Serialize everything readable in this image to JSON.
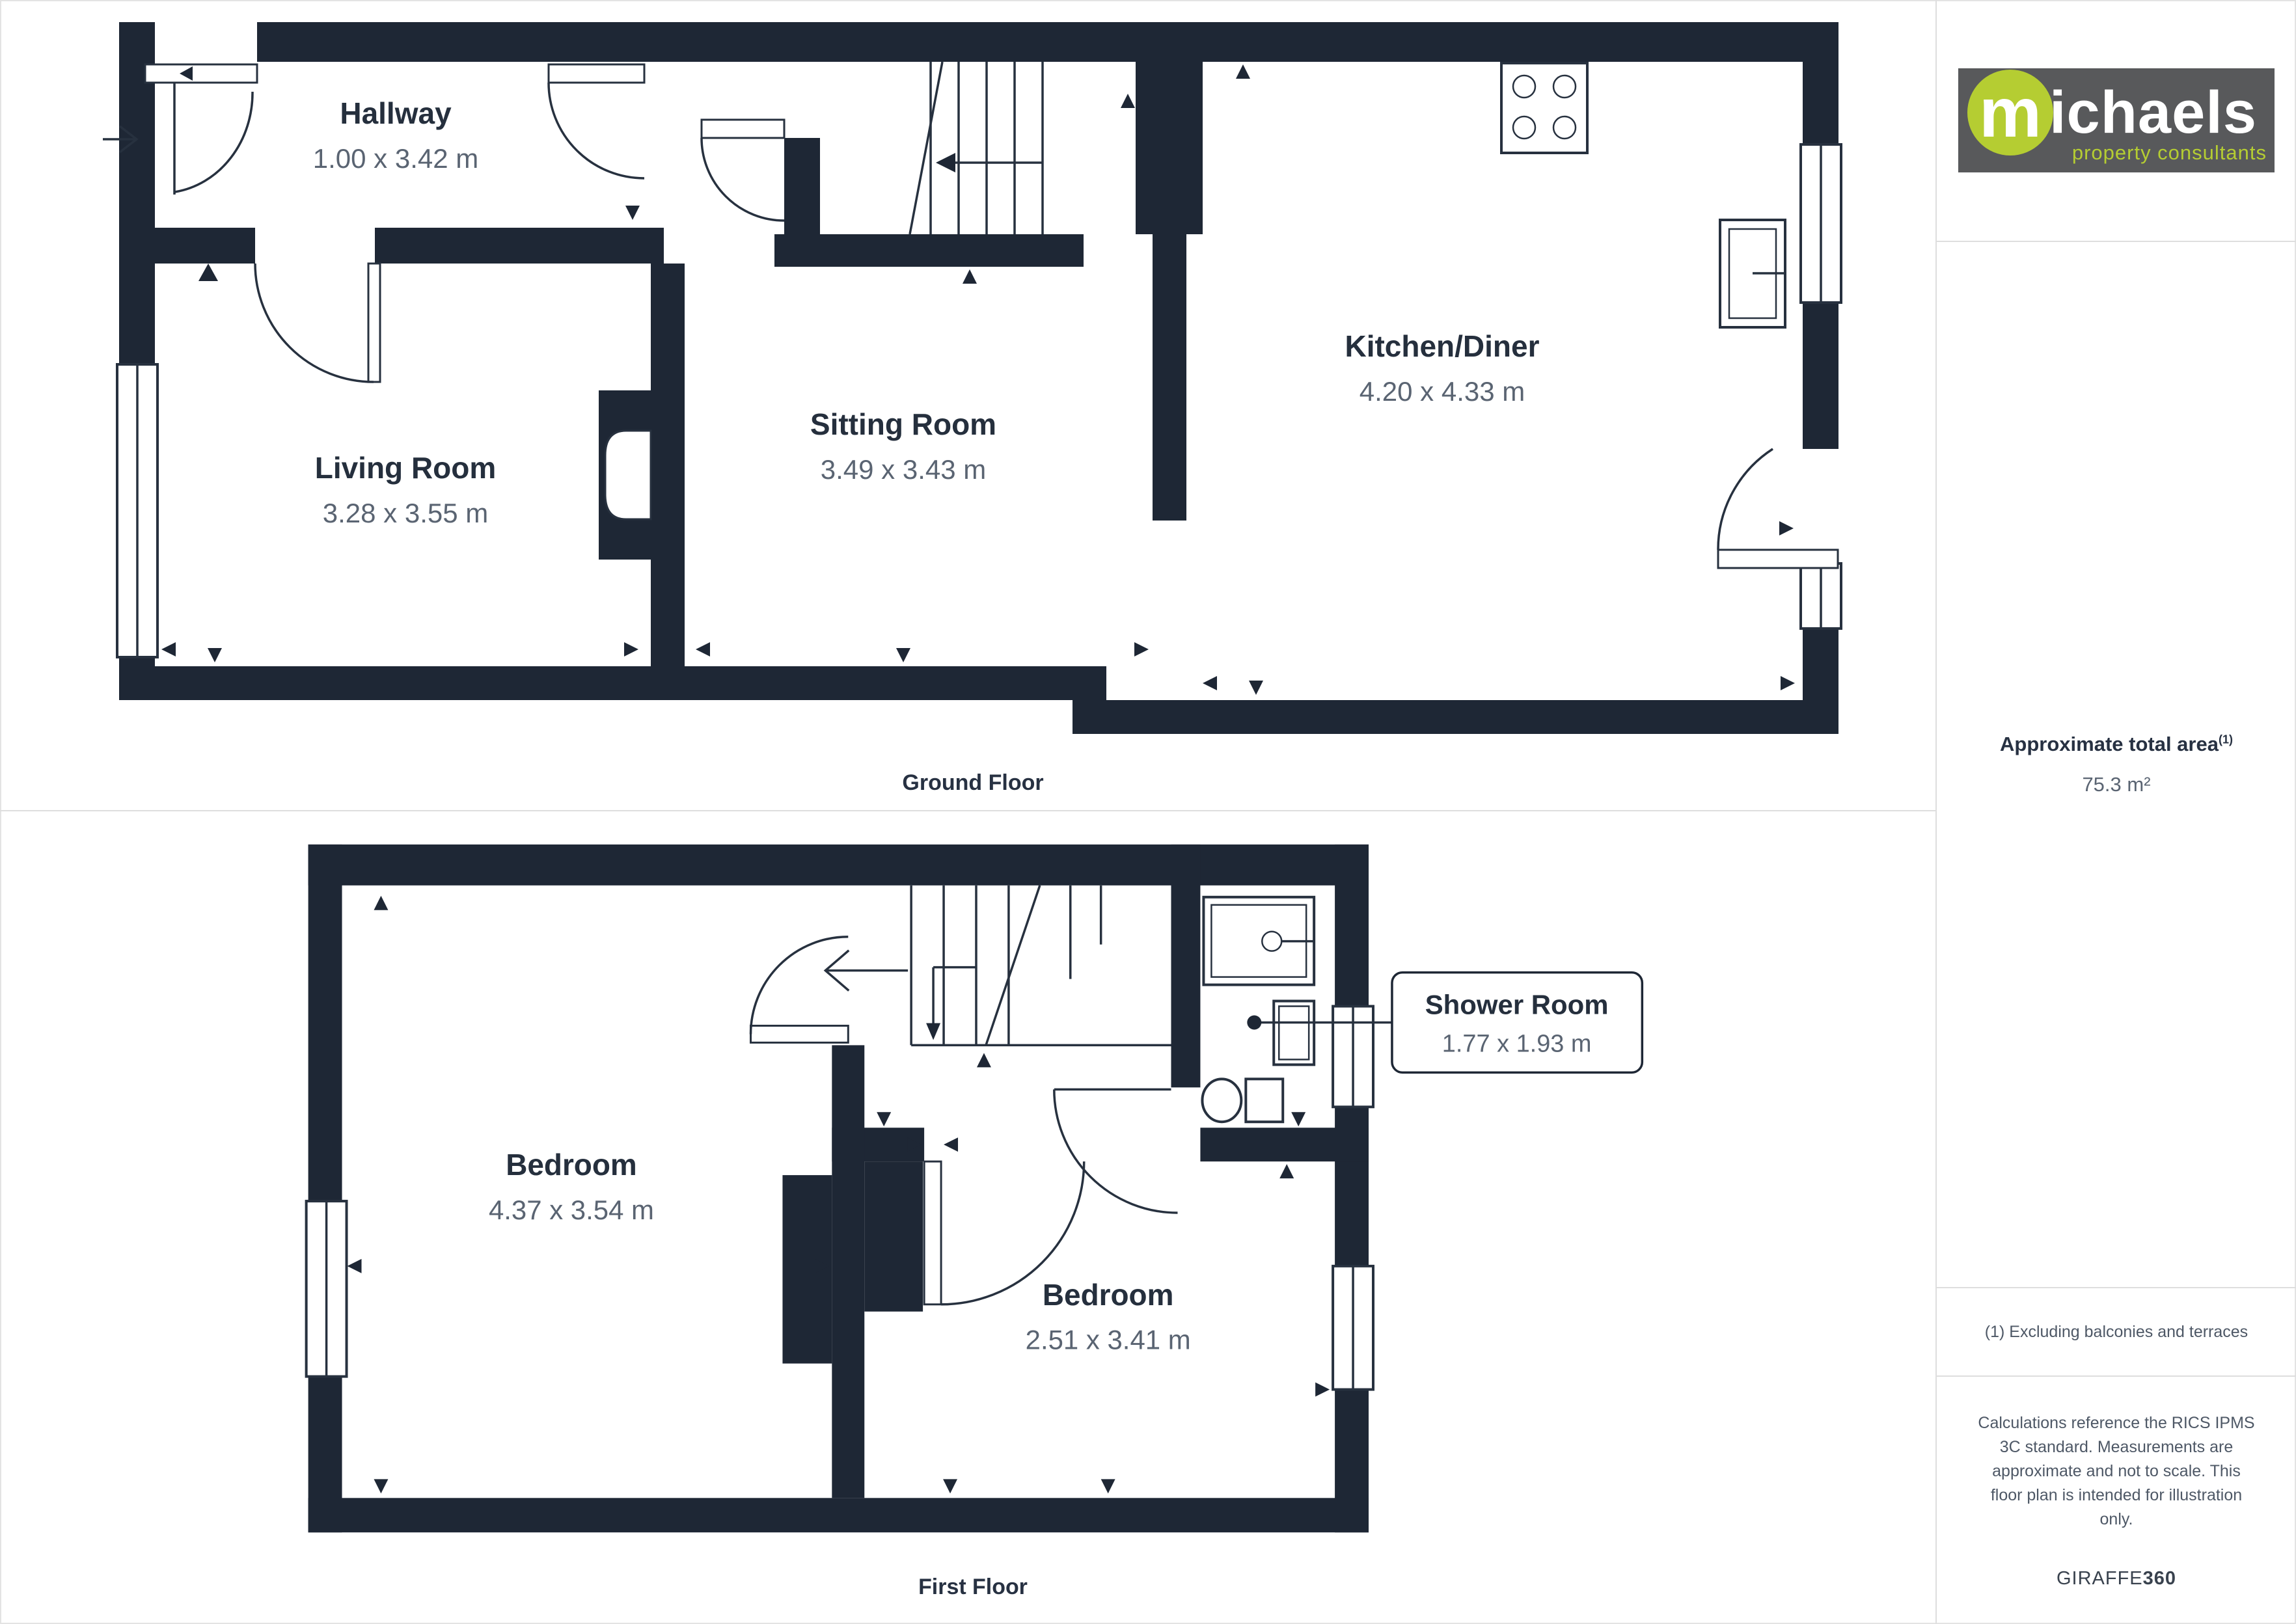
{
  "branding": {
    "logo_m": "m",
    "logo_rest": "ichaels",
    "tagline": "property consultants",
    "logo_bg": "#58595b",
    "logo_green": "#b5cd32"
  },
  "sidebar": {
    "total_area_label": "Approximate total area",
    "total_area_sup": "(1)",
    "total_area_value": "75.3 m²",
    "footnote": "(1) Excluding balconies and terraces",
    "disclaimer": "Calculations reference the RICS IPMS 3C standard. Measurements are approximate and not to scale. This floor plan is intended for illustration only.",
    "brand_giraffe": "GIRAFFE",
    "brand_360": "360"
  },
  "colors": {
    "wall": "#1e2735",
    "room_name_text": "#252f3d",
    "dimension_text": "#5a6472",
    "divider": "#dedede"
  },
  "floors": [
    {
      "label": "Ground Floor",
      "rooms": [
        {
          "name": "Hallway",
          "dims": "1.00 x 3.42 m"
        },
        {
          "name": "Living Room",
          "dims": "3.28 x 3.55 m"
        },
        {
          "name": "Sitting Room",
          "dims": "3.49 x 3.43 m"
        },
        {
          "name": "Kitchen/Diner",
          "dims": "4.20 x 4.33 m"
        }
      ]
    },
    {
      "label": "First Floor",
      "rooms": [
        {
          "name": "Bedroom",
          "dims": "4.37 x 3.54 m"
        },
        {
          "name": "Bedroom",
          "dims": "2.51 x 3.41 m"
        },
        {
          "name": "Shower Room",
          "dims": "1.77 x 1.93 m"
        }
      ]
    }
  ]
}
